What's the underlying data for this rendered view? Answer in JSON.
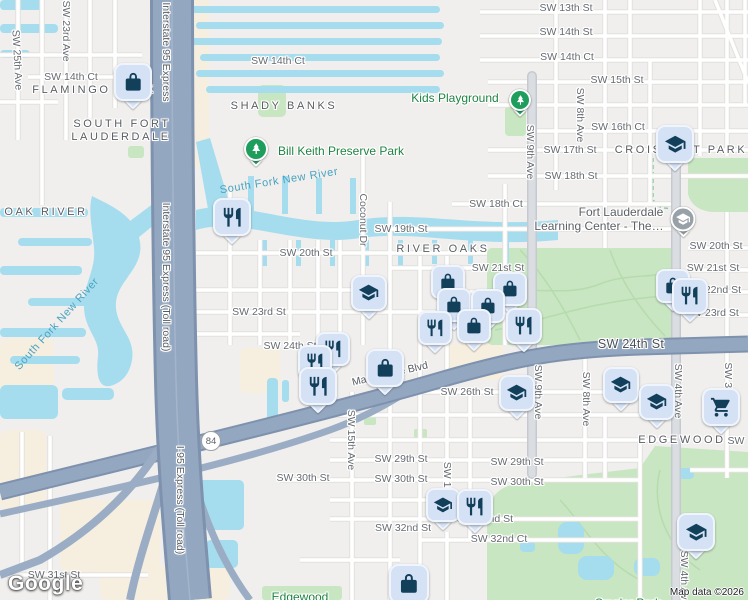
{
  "map": {
    "attribution": "Map data ©2026",
    "logo": "Google",
    "route_shield": "84"
  },
  "colors": {
    "pin_fill": "#d5e2f6",
    "pin_border": "#f0f5fd",
    "pin_glyph": "#123f5a",
    "water": "#a5ddee",
    "park_green": "#c8e6c1",
    "highway": "#93a7c1",
    "park_label_green": "#1e8342",
    "water_label_blue": "#49a3c1"
  },
  "icons": {
    "bag": "shopping-bag-icon",
    "restaurant": "restaurant-icon",
    "edu": "school-icon",
    "cart": "shopping-cart-icon",
    "tree": "park-tree-icon",
    "learning": "school-icon"
  },
  "labels": [
    {
      "t": "SW 13th St",
      "x": 566,
      "y": 8,
      "k": "st"
    },
    {
      "t": "SW 14th St",
      "x": 566,
      "y": 32,
      "k": "st"
    },
    {
      "t": "SW 14th Ct",
      "x": 567,
      "y": 57,
      "k": "st"
    },
    {
      "t": "SW 15th St",
      "x": 617,
      "y": 80,
      "k": "st"
    },
    {
      "t": "SW 16th Ct",
      "x": 618,
      "y": 127,
      "k": "st"
    },
    {
      "t": "SW 17th St",
      "x": 570,
      "y": 150,
      "k": "st"
    },
    {
      "t": "SW 18th St",
      "x": 571,
      "y": 176,
      "k": "st"
    },
    {
      "t": "SW 18th Ct",
      "x": 496,
      "y": 204,
      "k": "st"
    },
    {
      "t": "SW 14th Ct",
      "x": 278,
      "y": 61,
      "k": "st"
    },
    {
      "t": "SW 14th Ct",
      "x": 71,
      "y": 77,
      "k": "st"
    },
    {
      "t": "SW 19th St",
      "x": 401,
      "y": 229,
      "k": "st"
    },
    {
      "t": "SW 20th St",
      "x": 306,
      "y": 253,
      "k": "st"
    },
    {
      "t": "SW 20th St",
      "x": 716,
      "y": 246,
      "k": "st"
    },
    {
      "t": "SW 21st St",
      "x": 498,
      "y": 268,
      "k": "st"
    },
    {
      "t": "SW 21st St",
      "x": 713,
      "y": 268,
      "k": "st"
    },
    {
      "t": "SW 22nd St",
      "x": 713,
      "y": 290,
      "k": "st"
    },
    {
      "t": "SW 23rd St",
      "x": 259,
      "y": 312,
      "k": "st"
    },
    {
      "t": "SW 23rd St",
      "x": 712,
      "y": 313,
      "k": "st"
    },
    {
      "t": "SW 24th St",
      "x": 290,
      "y": 346,
      "k": "st"
    },
    {
      "t": "SW 24th St",
      "x": 631,
      "y": 344,
      "k": "stm"
    },
    {
      "t": "SW 26th St",
      "x": 467,
      "y": 392,
      "k": "st"
    },
    {
      "t": "SW 29th St",
      "x": 401,
      "y": 459,
      "k": "st"
    },
    {
      "t": "SW 29th St",
      "x": 517,
      "y": 462,
      "k": "st"
    },
    {
      "t": "SW 30th St",
      "x": 303,
      "y": 478,
      "k": "st"
    },
    {
      "t": "SW 30th St",
      "x": 401,
      "y": 479,
      "k": "st"
    },
    {
      "t": "SW 30th St",
      "x": 517,
      "y": 482,
      "k": "st"
    },
    {
      "t": "SW 31st St",
      "x": 54,
      "y": 575,
      "k": "st"
    },
    {
      "t": "SW 32nd St",
      "x": 403,
      "y": 528,
      "k": "st"
    },
    {
      "t": "SW 32nd St",
      "x": 485,
      "y": 519,
      "k": "st"
    },
    {
      "t": "SW 32nd Ct",
      "x": 499,
      "y": 539,
      "k": "st"
    },
    {
      "t": "SW",
      "x": 736,
      "y": 441,
      "k": "st"
    },
    {
      "t": "SW 25th Ave",
      "x": 17,
      "y": 60,
      "k": "st",
      "r": 87
    },
    {
      "t": "SW 23rd Ave",
      "x": 66,
      "y": 31,
      "k": "st",
      "r": 90
    },
    {
      "t": "SW 9th Ave",
      "x": 530,
      "y": 152,
      "k": "st",
      "r": 90
    },
    {
      "t": "SW 8th Ave",
      "x": 580,
      "y": 115,
      "k": "st",
      "r": 90
    },
    {
      "t": "Coconut Dr",
      "x": 363,
      "y": 220,
      "k": "st",
      "r": 90
    },
    {
      "t": "SW 15th Ave",
      "x": 351,
      "y": 440,
      "k": "st",
      "r": 90
    },
    {
      "t": "SW 12th Ave",
      "x": 447,
      "y": 492,
      "k": "st",
      "r": 90
    },
    {
      "t": "SW 9th Ave",
      "x": 538,
      "y": 392,
      "k": "st",
      "r": 90
    },
    {
      "t": "SW 8th Ave",
      "x": 586,
      "y": 399,
      "k": "st",
      "r": 90
    },
    {
      "t": "SW 4th Ave",
      "x": 678,
      "y": 391,
      "k": "st",
      "r": 90
    },
    {
      "t": "SW 3rd Ave",
      "x": 728,
      "y": 390,
      "k": "st",
      "r": 90
    },
    {
      "t": "SW 4th Ave",
      "x": 684,
      "y": 578,
      "k": "st",
      "r": 90
    },
    {
      "t": "Interstate 95 Express",
      "x": 166,
      "y": 52,
      "k": "hw",
      "r": 90
    },
    {
      "t": "Interstate 95 Express (Toll road)",
      "x": 166,
      "y": 277,
      "k": "hw",
      "r": 90
    },
    {
      "t": "I-95 Express (Toll road)",
      "x": 180,
      "y": 500,
      "k": "hw",
      "r": 90
    },
    {
      "t": "Marina Mile Blvd",
      "x": 390,
      "y": 374,
      "k": "hw",
      "r": -13
    },
    {
      "t": "Marina Mile Blvd",
      "x": 791,
      "y": 347,
      "k": "hw",
      "r": -2
    },
    {
      "t": "FLAMINGO PARK",
      "x": 94,
      "y": 90,
      "k": "nb"
    },
    {
      "t": "SOUTH FORT",
      "x": 122,
      "y": 124,
      "k": "nb"
    },
    {
      "t": "LAUDERDALE",
      "x": 121,
      "y": 137,
      "k": "nb"
    },
    {
      "t": "SHADY BANKS",
      "x": 284,
      "y": 106,
      "k": "nb"
    },
    {
      "t": "OAK RIVER",
      "x": 46,
      "y": 212,
      "k": "nb"
    },
    {
      "t": "RIVER OAKS",
      "x": 443,
      "y": 249,
      "k": "nb"
    },
    {
      "t": "CROISSANT PARK",
      "x": 681,
      "y": 150,
      "k": "nb"
    },
    {
      "t": "EDGEWOOD",
      "x": 682,
      "y": 440,
      "k": "nb"
    },
    {
      "t": "South Fork New River",
      "x": 279,
      "y": 181,
      "k": "wa",
      "r": -9
    },
    {
      "t": "South Fork New River",
      "x": 57,
      "y": 324,
      "k": "wa",
      "r": -48
    },
    {
      "t": "Bill Keith Preserve Park",
      "x": 341,
      "y": 151,
      "k": "pk"
    },
    {
      "t": "Kids Playground",
      "x": 455,
      "y": 98,
      "k": "pk"
    },
    {
      "t": "Edgewood",
      "x": 300,
      "y": 597,
      "k": "pk"
    },
    {
      "t": "Snyder Park",
      "x": 628,
      "y": 603,
      "k": "pk"
    },
    {
      "t": "Fort Lauderdale",
      "x": 621,
      "y": 212,
      "k": "poi"
    },
    {
      "t": "Learning Center - The…",
      "x": 599,
      "y": 226,
      "k": "poi"
    }
  ],
  "markers": [
    {
      "t": "bag",
      "x": 133,
      "y": 82,
      "s": 38
    },
    {
      "t": "edu",
      "x": 675,
      "y": 144,
      "s": 38
    },
    {
      "t": "restaurant",
      "x": 232,
      "y": 217,
      "s": 38
    },
    {
      "t": "edu",
      "x": 369,
      "y": 293,
      "s": 36
    },
    {
      "t": "bag",
      "x": 448,
      "y": 282,
      "s": 34
    },
    {
      "t": "bag",
      "x": 510,
      "y": 289,
      "s": 34
    },
    {
      "t": "bag",
      "x": 454,
      "y": 305,
      "s": 34
    },
    {
      "t": "bag",
      "x": 488,
      "y": 306,
      "s": 34
    },
    {
      "t": "bag",
      "x": 474,
      "y": 326,
      "s": 34
    },
    {
      "t": "restaurant",
      "x": 435,
      "y": 328,
      "s": 34
    },
    {
      "t": "restaurant",
      "x": 524,
      "y": 326,
      "s": 36
    },
    {
      "t": "bag",
      "x": 673,
      "y": 286,
      "s": 34
    },
    {
      "t": "restaurant",
      "x": 690,
      "y": 296,
      "s": 36
    },
    {
      "t": "restaurant",
      "x": 333,
      "y": 349,
      "s": 34
    },
    {
      "t": "restaurant",
      "x": 315,
      "y": 362,
      "s": 34
    },
    {
      "t": "restaurant",
      "x": 318,
      "y": 386,
      "s": 38
    },
    {
      "t": "bag",
      "x": 385,
      "y": 368,
      "s": 38
    },
    {
      "t": "edu",
      "x": 517,
      "y": 393,
      "s": 36
    },
    {
      "t": "edu",
      "x": 621,
      "y": 385,
      "s": 36
    },
    {
      "t": "edu",
      "x": 657,
      "y": 402,
      "s": 36
    },
    {
      "t": "cart",
      "x": 721,
      "y": 407,
      "s": 38
    },
    {
      "t": "edu",
      "x": 443,
      "y": 505,
      "s": 34
    },
    {
      "t": "restaurant",
      "x": 475,
      "y": 507,
      "s": 36
    },
    {
      "t": "edu",
      "x": 696,
      "y": 532,
      "s": 38
    },
    {
      "t": "bag",
      "x": 409,
      "y": 584,
      "s": 40
    },
    {
      "t": "tree",
      "x": 256,
      "y": 149,
      "s": 24
    },
    {
      "t": "tree",
      "x": 520,
      "y": 100,
      "s": 22
    },
    {
      "t": "learning",
      "x": 683,
      "y": 219,
      "s": 25
    }
  ]
}
